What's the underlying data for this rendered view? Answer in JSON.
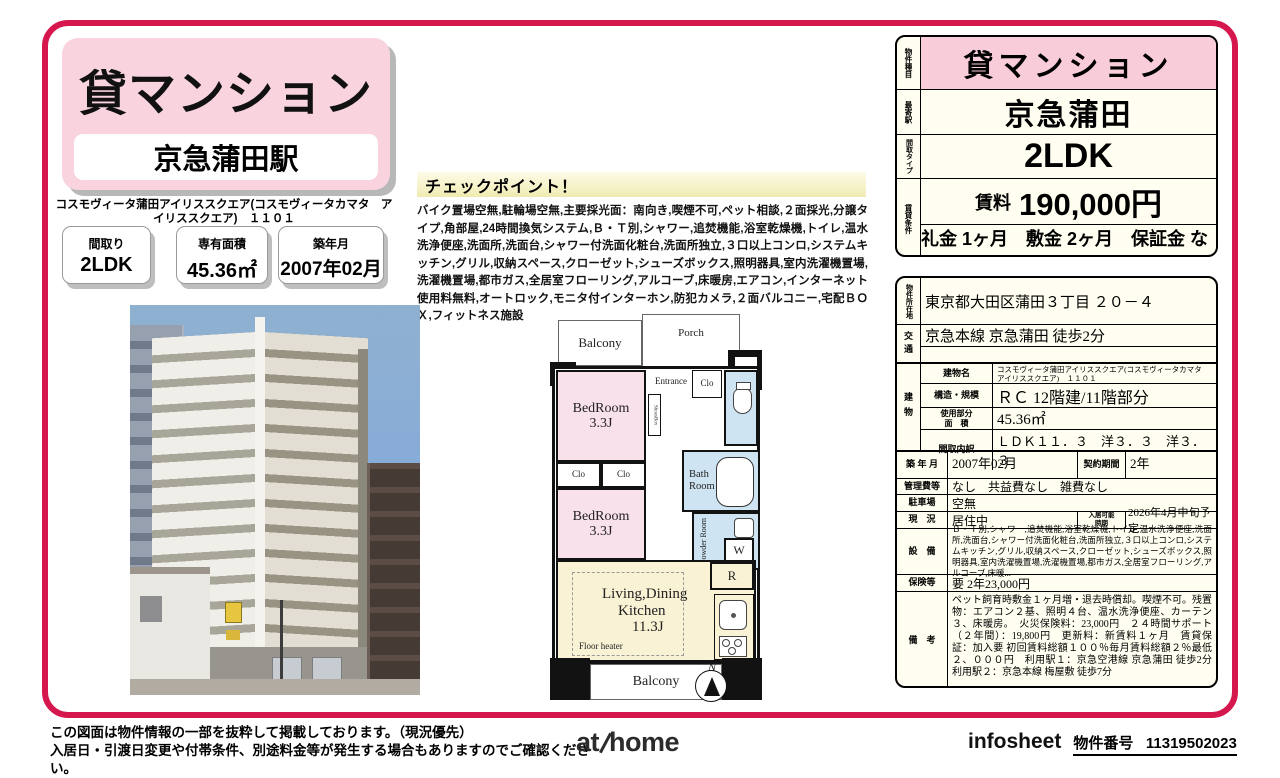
{
  "colors": {
    "frame_pink": "#d5174e",
    "light_pink": "#f9d3de",
    "table_pink": "#f8cdd9",
    "ivory": "#fffef0",
    "checkpoint_yellow": "#f3efbe",
    "plan_pink": "#f9e1ec",
    "plan_blue": "#cfe4f2",
    "plan_cream": "#faf2d4"
  },
  "header": {
    "property_type": "貸マンション",
    "station": "京急蒲田駅",
    "building_name": "コスモヴィータ蒲田アイリススクエア(コスモヴィータカマタ　アイリススクエア)　１１０１",
    "badges": [
      {
        "label": "間取り",
        "value": "2LDK"
      },
      {
        "label": "専有面積",
        "value": "45.36㎡"
      },
      {
        "label": "築年月",
        "value": "2007年02月"
      }
    ]
  },
  "checkpoint": {
    "title": "チェックポイント！",
    "text": "バイク置場空無,駐輪場空無,主要採光面：南向き,喫煙不可,ペット相談,２面採光,分譲タイプ,角部屋,24時間換気システム,Ｂ・Ｔ別,シャワー,追焚機能,浴室乾燥機,トイレ,温水洗浄便座,洗面所,洗面台,シャワー付洗面化粧台,洗面所独立,３口以上コンロ,システムキッチン,グリル,収納スペース,クローゼット,シューズボックス,照明器具,室内洗濯機置場,洗濯機置場,都市ガス,全居室フローリング,アルコーブ,床暖房,エアコン,インターネット使用料無料,オートロック,モニタ付インターホン,防犯カメラ,２面バルコニー,宅配ＢＯＸ,フィットネス施設"
  },
  "floor_plan": {
    "balcony_top": "Balcony",
    "porch": "Porch",
    "mb": "MB",
    "ps": "PS",
    "entrance": "Entrance",
    "shoes_box": "ShoesBox",
    "closet_entry": "Clo",
    "bedroom1_name": "BedRoom",
    "bedroom1_size": "3.3J",
    "closet1": "Clo",
    "closet2": "Clo",
    "bedroom2_name": "BedRoom",
    "bedroom2_size": "3.3J",
    "bath_line1": "Bath",
    "bath_line2": "Room",
    "powder_room": "Powder Room",
    "washer": "W",
    "fridge": "R",
    "ldk_line1": "Living,Dining",
    "ldk_line2": "Kitchen",
    "ldk_size": "11.3J",
    "floor_heater": "Floor heater",
    "balcony_bottom": "Balcony",
    "compass": "N"
  },
  "summary": {
    "property_type": {
      "label": "物件種目",
      "value": "貸マンション"
    },
    "station": {
      "label": "最寄駅",
      "value": "京急蒲田"
    },
    "layout": {
      "label": "間取タイプ",
      "value": "2LDK"
    },
    "terms": {
      "label": "賃貸条件",
      "rent_label": "賃料",
      "rent": "190,000円",
      "sub": "礼金 1ヶ月　敷金 2ヶ月　保証金 なし"
    }
  },
  "detail": {
    "address": {
      "label": "物件所在地",
      "value": "東京都大田区蒲田３丁目 ２０－４"
    },
    "access": {
      "label": "交通",
      "value": "京急本線 京急蒲田 徒歩2分"
    },
    "building_label": "建物",
    "building_rows": [
      {
        "label": "建物名",
        "value": "コスモヴィータ蒲田アイリススクエア(コスモヴィータカマタ　アイリススクエア)　１１０１"
      },
      {
        "label": "構造・規模",
        "value": "ＲＣ 12階建/11階部分"
      },
      {
        "label": "使用部分\n面　積",
        "value": "45.36㎡"
      },
      {
        "label": "間取内訳",
        "value": "ＬＤＫ１１．３　洋３．３　洋３．３"
      }
    ],
    "built": {
      "label": "築 年 月",
      "value": "2007年02月"
    },
    "contract": {
      "label": "契約期間",
      "value": "2年"
    },
    "fees": {
      "label": "管理費等",
      "value": "なし　共益費なし　雑費なし"
    },
    "parking": {
      "label": "駐車場",
      "value": "空無"
    },
    "status": {
      "label": "現　況",
      "value": "居住中"
    },
    "move_in": {
      "label": "入居可能\n時期",
      "value": "2026年4月中旬予定"
    },
    "equipment": {
      "label": "設　備",
      "value": "Ｂ・Ｔ別,シャワー,追焚機能,浴室乾燥機,トイレ,温水洗浄便座,洗面所,洗面台,シャワー付洗面化粧台,洗面所独立,３口以上コンロ,システムキッチン,グリル,収納スペース,クローゼット,シューズボックス,照明器具,室内洗濯機置場,洗濯機置場,都市ガス,全居室フローリング,アルコーブ,床暖..."
    },
    "insurance": {
      "label": "保険等",
      "value": "要 2年23,000円"
    },
    "notes": {
      "label": "備　考",
      "value": "ペット飼育時敷金１ヶ月増・退去時償却。喫煙不可。残置物：エアコン２基、照明４台、温水洗浄便座、カーテン３、床暖房。　火災保険料：23,000円　２４時間サポート（２年間）：19,800円　更新料：新賃料１ヶ月　賃貸保証：加入要 初回賃料総額１００％毎月賃料総額２％最低２、０００円　利用駅１：京急空港線 京急蒲田 徒歩2分　利用駅２：京急本線 梅屋敷 徒歩7分"
    }
  },
  "footer": {
    "disclaimer1": "この図面は物件情報の一部を抜粋して掲載しております。（現況優先）",
    "disclaimer2": "入居日・引渡日変更や付帯条件、別途料金等が発生する場合もありますのでご確認ください。",
    "logo_at": "at",
    "logo_home": "home",
    "sheet_label": "infosheet",
    "property_no_label": "物件番号",
    "property_no": "11319502023"
  }
}
